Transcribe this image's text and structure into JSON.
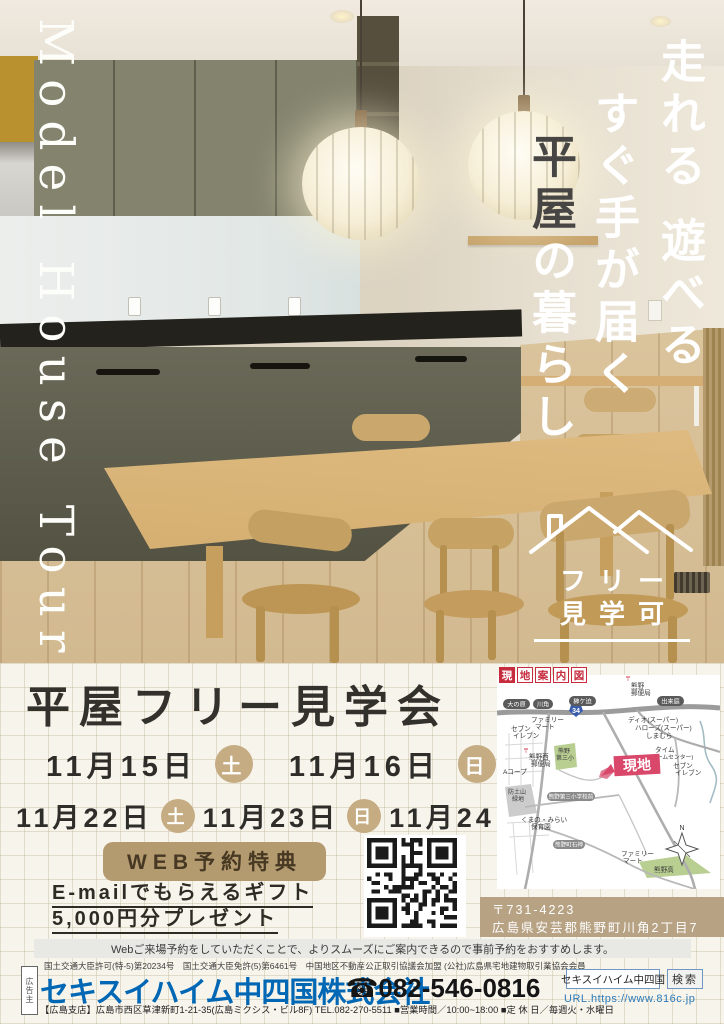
{
  "photo": {
    "vertical_title": "Model House Tour",
    "headline_col1": "走れる 遊べる",
    "headline_col2": "すぐ手が届く",
    "headline_col3_dark": "平屋",
    "headline_col3_light": "の暮らし",
    "free_badge_line1": "フリー",
    "free_badge_line2": "見学可"
  },
  "event": {
    "title": "平屋フリー見学会",
    "dates": [
      {
        "date": "11月15日",
        "day": "土"
      },
      {
        "date": "11月16日",
        "day": "日"
      },
      {
        "date": "11月22日",
        "day": "土"
      },
      {
        "date": "11月23日",
        "day": "日"
      },
      {
        "date": "11月24日",
        "day": "月"
      }
    ],
    "web_badge": "WEB予約特典",
    "gift_line1": "E-mailでもらえるギフト",
    "gift_line2": "5,000円分プレゼント"
  },
  "map": {
    "title_chars": [
      "現",
      "地",
      "案",
      "内",
      "図"
    ],
    "route_badge": "34",
    "site_label": "現地",
    "compass_n": "N",
    "labels": {
      "oonohara": [
        "大の原"
      ],
      "kawasumi": [
        "川角"
      ],
      "sakaki": [
        "榊ケ迫"
      ],
      "dekiniwa": [
        "出来庭"
      ],
      "post": [
        "熊野",
        "郵便局"
      ],
      "fm1": [
        "ファミリー",
        "マート"
      ],
      "seven1": [
        "セブン",
        "イレブン"
      ],
      "dio": [
        "ディオ(スーパー)"
      ],
      "halows": [
        "ハローズ(スーパー)"
      ],
      "shimamura": [
        "しまむら"
      ],
      "time": [
        "タイム",
        "(ホームセンター)"
      ],
      "seven2": [
        "セブン",
        "イレブン"
      ],
      "westpost": [
        "熊野西",
        "郵便局"
      ],
      "daisan": [
        "熊野",
        "第三小"
      ],
      "acoop": [
        "Aコープ"
      ],
      "bodo": [
        "防土山",
        "緑地"
      ],
      "daisanmae": [
        "熊野第三小学校前"
      ],
      "hoikuen": [
        "くまの・みらい",
        "保育園"
      ],
      "ishigami": [
        "熊野町石神"
      ],
      "fm2": [
        "ファミリー",
        "マート"
      ],
      "high": [
        "熊野高"
      ]
    }
  },
  "address": {
    "postal": "〒731-4223",
    "street": "広島県安芸郡熊野町川角2丁目7"
  },
  "notice": "Webご来場予約をしていただくことで、よりスムーズにご案内できるので事前予約をおすすめします。",
  "license": "国土交通大臣許可(特-5)第20234号　国土交通大臣免許(5)第6461号　中国地区不動産公正取引協議会加盟 (公社)広島県宅地建物取引業協会会員",
  "footer": {
    "advertiser_box": "広告主",
    "company": "セキスイハイム中四国株式会社",
    "phone": "☎082-546-0816",
    "branch": "【広島支店】広島市西区草津新町1-21-35(広島ミクシス・ビル8F) TEL.082-270-5511 ■営業時間／10:00~18:00 ■定 休 日／毎週火・水曜日",
    "search_value": "セキスイハイム中四国",
    "search_button": "検索",
    "url": "URL.https://www.816c.jp"
  }
}
